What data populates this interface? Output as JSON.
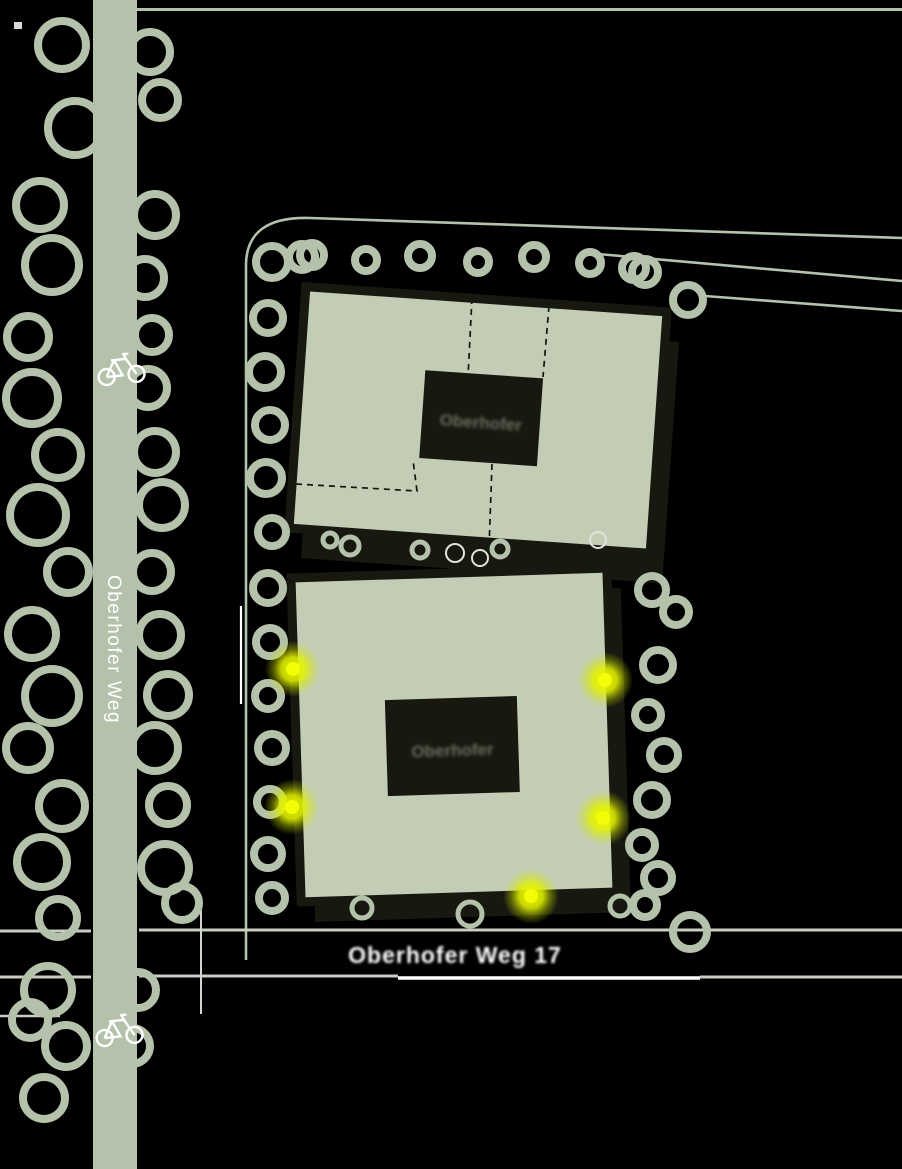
{
  "map": {
    "type": "site-plan",
    "labels": {
      "street_vertical": "Oberhofer Weg",
      "street_bottom": "Oberhofer Weg 17",
      "building_top_courtyard": "Oberhofer",
      "building_bottom_courtyard": "Oberhofer"
    },
    "features": {
      "buildings": 2,
      "light_marker_count": 5,
      "bicycle_icon_count": 2
    },
    "colors": {
      "background": "#000000",
      "road_and_trees": "#b5c2ab",
      "building_fill": "#c3cdb6",
      "building_shadow": "#17180f",
      "road_line_gray": "#c7cdc2",
      "road_line_white": "#ffffff",
      "marker_glow": "#e3f400",
      "marker_dot": "#f3fd05",
      "label_white": "#ffffff"
    }
  }
}
